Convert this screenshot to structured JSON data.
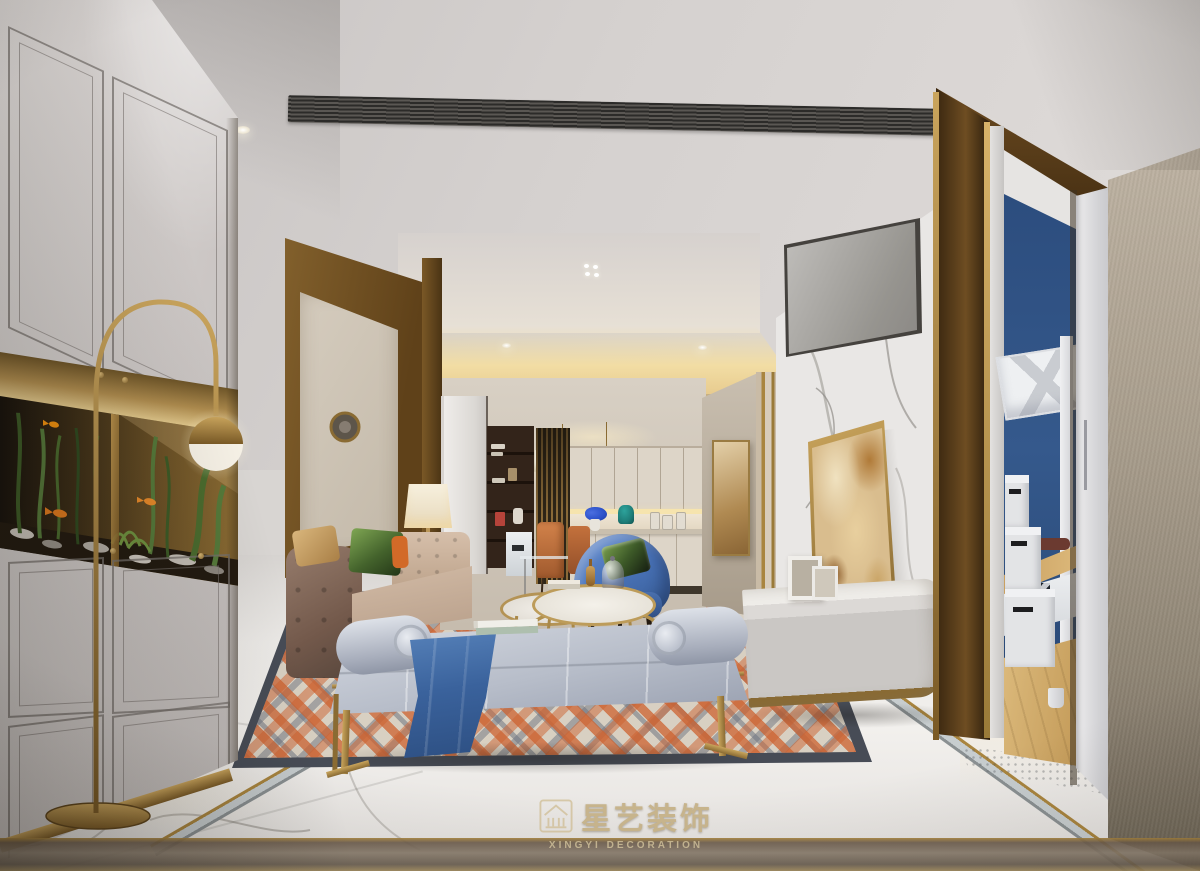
{
  "watermark": {
    "icon": "pavilion-logo-icon",
    "title_cn": "星艺装饰",
    "subtitle_en": "XINGYI DECORATION"
  },
  "palette": {
    "brass": "#a9853f",
    "brassDark": "#6b5226",
    "bronzeWall": "#6e4d22",
    "creamCab": "#ddd5c8",
    "wallBeige": "#b3a896",
    "marbleFloor": "#eceae7",
    "ceilingGray": "#d5d1cf",
    "coveGlow": "#f0dba2",
    "ventDark": "#34322f",
    "sofaBeige": "#c3ac99",
    "sofaBrown": "#7c655a",
    "benchGray": "#bcc2cd",
    "runnerBlue": "#3f6ca8",
    "armchairBlue": "#4a74ba",
    "chairOrange": "#c4703d",
    "pillowGreen": "#55783a",
    "rugOrange": "#cd6230",
    "rugSlate": "#6f7480",
    "rugCream": "#d8d0c2",
    "rugBorder": "#474c56",
    "marbleWall": "#e9e7e5",
    "artAmber": "#c89a5a",
    "bedroomBlue": "#2e4f80",
    "woodFloor": "#cfa96b",
    "wmGold": "#c2ac7e",
    "fishOrange": "#e07a1e",
    "aquaGreen": "#4a6b2e"
  }
}
